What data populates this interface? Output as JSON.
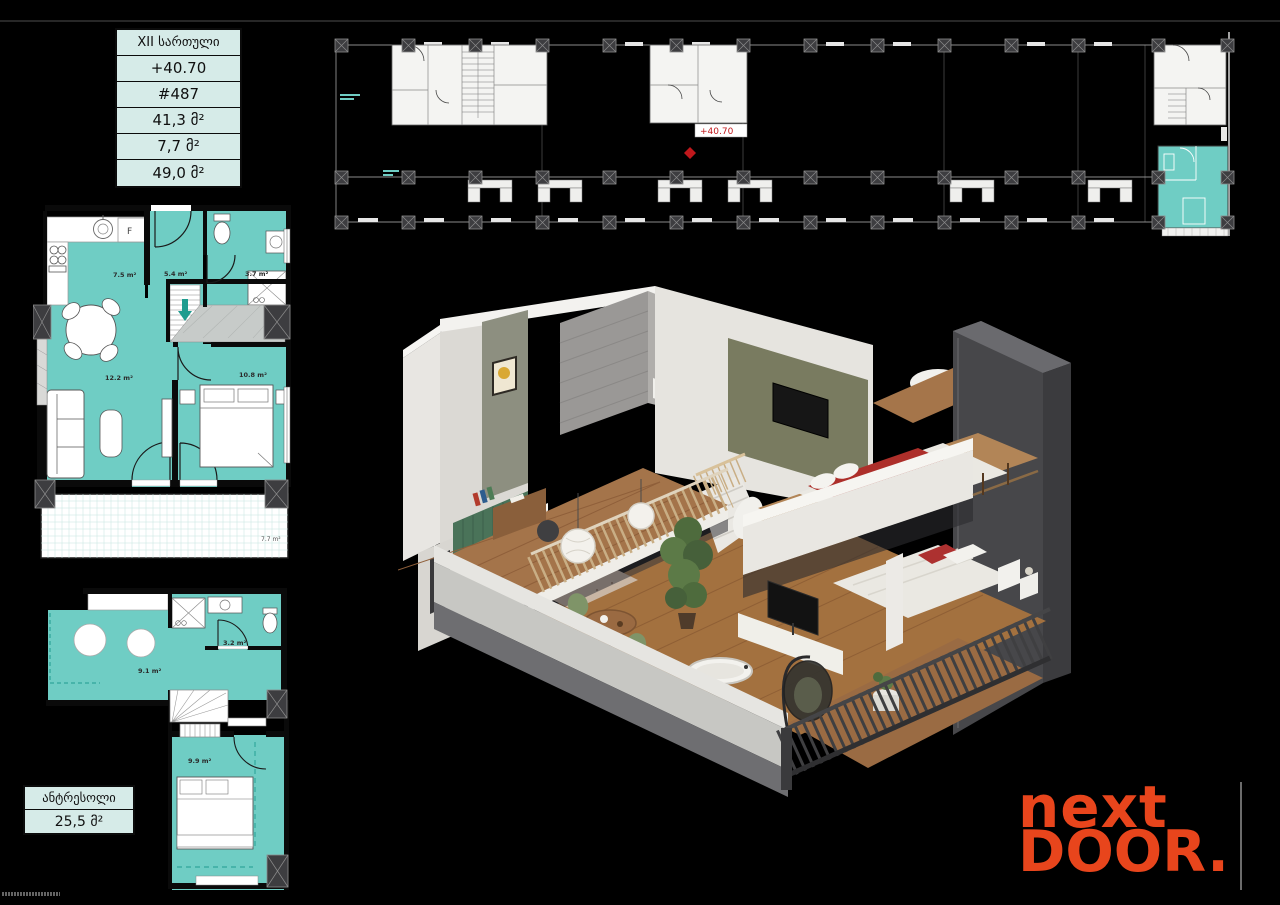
{
  "colors": {
    "plan_teal": "#6fcdc4",
    "logo_orange": "#e8451c",
    "marker_red": "#c0181c",
    "table_bg": "#d6ebe8"
  },
  "info_table": {
    "rows": [
      "XII სართული",
      "+40.70",
      "#487",
      "41,3 მ²",
      "7,7 მ²",
      "49,0 მ²"
    ]
  },
  "building_plan": {
    "elevation_marker": "+40.70"
  },
  "unit_plan": {
    "fridge": "F",
    "kitchen": "7.5 m²",
    "hall": "5.4 m²",
    "bathroom": "3.7 m²",
    "living": "12.2 m²",
    "bedroom": "10.8 m²",
    "balcony": "7.7 m²"
  },
  "mezzanine_plan": {
    "open_space": "9.1 m²",
    "bathroom": "3.2 m²",
    "bedroom": "9.9 m²"
  },
  "mezzanine_table": {
    "title": "ანტრესოლი",
    "area": "25,5 მ²"
  },
  "logo": {
    "line1": "next",
    "line2": "DOOR",
    "dot": "."
  }
}
